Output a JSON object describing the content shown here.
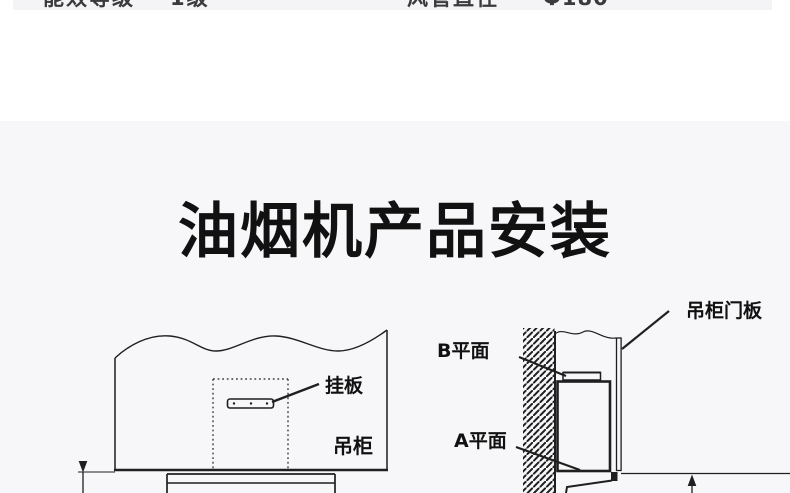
{
  "page": {
    "background": "#ffffff",
    "section_background": "#f7f6f8",
    "line_color": "#1f1f1f"
  },
  "spec_row": {
    "left_label": "能效等级",
    "left_value": "1级",
    "right_label": "风管直径",
    "right_value": "Φ180"
  },
  "section": {
    "title": "油烟机产品安装"
  },
  "diagram_left": {
    "labels": {
      "hanger_plate": "挂板",
      "cabinet": "吊柜"
    }
  },
  "diagram_right": {
    "labels": {
      "b_plane": "B平面",
      "a_plane": "A平面",
      "door_panel": "吊柜门板"
    }
  }
}
